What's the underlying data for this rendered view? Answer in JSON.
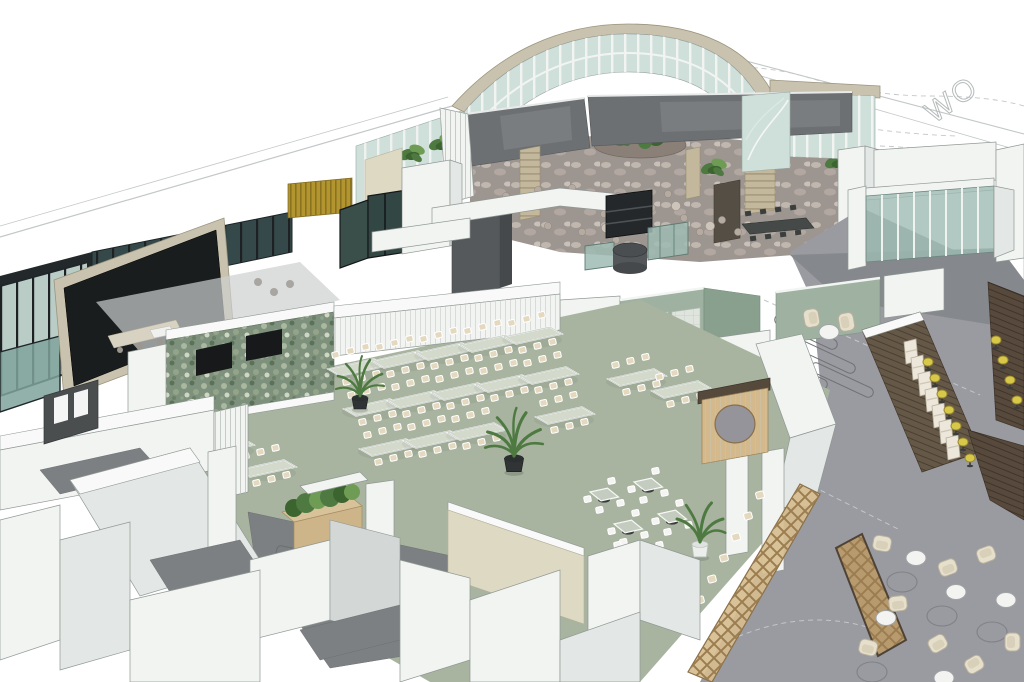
{
  "siteplan": {
    "road_text": "WO"
  },
  "colors": {
    "white": "#ffffff",
    "edge": "#909894",
    "faint": "#c3c7c8",
    "wallWhite": "#f2f4f2",
    "wallShade": "#e3e7e5",
    "wallTop": "#f8f9f8",
    "wallDeep": "#d3d8d6",
    "floorSage": "#a8b4a0",
    "sageWall": "#9fb2a2",
    "sageDark": "#8aa08e",
    "moss": "#7e917c",
    "cream": "#ded9c3",
    "tan": "#c9c2ae",
    "stone": "#c3b89c",
    "atriumFloor": "#9d9590",
    "charcoal": "#6d7072",
    "darkPanel": "#55595b",
    "black": "#1a1d1e",
    "glass": "#cfe0da",
    "glassDark": "#35494a",
    "glassTeal": "#9dbbb3",
    "mullion": "#f2f4f2",
    "gold": "#b3952f",
    "goldDark": "#8a7320",
    "woodLight": "#d3b98c",
    "woodMid": "#b79b6e",
    "woodDark": "#655847",
    "woodDeep": "#57493c",
    "corridor": "#9a9aa1",
    "corridorDark": "#85888d",
    "walkDark": "#7d8082",
    "tableTop": "#d3dacc",
    "chairSeat": "#e4d9bf",
    "taupeChair": "#b5aba1",
    "creamChair": "#e6dfcc",
    "yellow": "#d8c84a",
    "leaf": "#4e7a42",
    "leafLight": "#6f9c55",
    "leafDeep": "#3c642f",
    "pot": "#2b2f30",
    "tv": "#17191a"
  },
  "scene": {
    "dining_tables": [
      {
        "x": 178,
        "y": 424
      },
      {
        "x": 220,
        "y": 447
      },
      {
        "x": 262,
        "y": 469
      },
      {
        "x": 352,
        "y": 368
      },
      {
        "x": 396,
        "y": 360
      },
      {
        "x": 440,
        "y": 352
      },
      {
        "x": 484,
        "y": 344
      },
      {
        "x": 528,
        "y": 336
      },
      {
        "x": 368,
        "y": 408
      },
      {
        "x": 412,
        "y": 400
      },
      {
        "x": 456,
        "y": 392
      },
      {
        "x": 500,
        "y": 384
      },
      {
        "x": 544,
        "y": 376
      },
      {
        "x": 384,
        "y": 448
      },
      {
        "x": 428,
        "y": 440
      },
      {
        "x": 472,
        "y": 432
      },
      {
        "x": 560,
        "y": 416
      },
      {
        "x": 632,
        "y": 378
      },
      {
        "x": 676,
        "y": 390
      }
    ],
    "square_tables": [
      {
        "x": 604,
        "y": 494
      },
      {
        "x": 648,
        "y": 484
      },
      {
        "x": 628,
        "y": 526
      },
      {
        "x": 672,
        "y": 516
      },
      {
        "x": 652,
        "y": 558
      },
      {
        "x": 610,
        "y": 558
      }
    ],
    "fence_chairs": [
      {
        "x": 700,
        "y": 600,
        "r": -15
      },
      {
        "x": 712,
        "y": 579,
        "r": -15
      },
      {
        "x": 724,
        "y": 558,
        "r": -15
      },
      {
        "x": 736,
        "y": 537,
        "r": -15
      },
      {
        "x": 748,
        "y": 516,
        "r": -15
      },
      {
        "x": 760,
        "y": 495,
        "r": -15
      }
    ],
    "atrium_chairs": [
      {
        "x": 506,
        "y": 196
      },
      {
        "x": 522,
        "y": 207
      },
      {
        "x": 538,
        "y": 190
      },
      {
        "x": 554,
        "y": 202
      },
      {
        "x": 572,
        "y": 188
      },
      {
        "x": 588,
        "y": 200
      },
      {
        "x": 604,
        "y": 214
      },
      {
        "x": 618,
        "y": 196
      },
      {
        "x": 634,
        "y": 222
      },
      {
        "x": 652,
        "y": 208
      },
      {
        "x": 668,
        "y": 194
      },
      {
        "x": 684,
        "y": 218
      },
      {
        "x": 700,
        "y": 232
      },
      {
        "x": 722,
        "y": 220
      },
      {
        "x": 738,
        "y": 232
      },
      {
        "x": 582,
        "y": 232
      },
      {
        "x": 548,
        "y": 226
      },
      {
        "x": 616,
        "y": 240
      }
    ],
    "atrium_tables": [
      {
        "x": 514,
        "y": 204
      },
      {
        "x": 546,
        "y": 196
      },
      {
        "x": 580,
        "y": 194
      },
      {
        "x": 612,
        "y": 206
      },
      {
        "x": 644,
        "y": 216
      },
      {
        "x": 676,
        "y": 206
      },
      {
        "x": 710,
        "y": 226
      },
      {
        "x": 606,
        "y": 228
      }
    ],
    "lounge_armchairs": [
      {
        "x": 882,
        "y": 544,
        "r": 10
      },
      {
        "x": 898,
        "y": 604,
        "r": -6
      },
      {
        "x": 868,
        "y": 648,
        "r": 14
      },
      {
        "x": 948,
        "y": 568,
        "r": -20
      },
      {
        "x": 986,
        "y": 554,
        "r": 160
      },
      {
        "x": 938,
        "y": 644,
        "r": -30
      },
      {
        "x": 974,
        "y": 664,
        "r": 150
      },
      {
        "x": 1012,
        "y": 642,
        "r": 90
      },
      {
        "x": 812,
        "y": 318,
        "r": -100
      },
      {
        "x": 846,
        "y": 322,
        "r": 80
      }
    ],
    "lounge_tables": [
      {
        "x": 916,
        "y": 558
      },
      {
        "x": 886,
        "y": 618
      },
      {
        "x": 956,
        "y": 592
      },
      {
        "x": 1006,
        "y": 600
      },
      {
        "x": 944,
        "y": 678
      },
      {
        "x": 829,
        "y": 332
      }
    ],
    "lounge_rugs": [
      {
        "x": 902,
        "y": 582
      },
      {
        "x": 942,
        "y": 616
      },
      {
        "x": 872,
        "y": 672
      },
      {
        "x": 992,
        "y": 632
      }
    ],
    "bar_booths": [
      {
        "x": 910,
        "y": 352
      },
      {
        "x": 917,
        "y": 368
      },
      {
        "x": 924,
        "y": 384
      },
      {
        "x": 931,
        "y": 400
      },
      {
        "x": 938,
        "y": 416
      },
      {
        "x": 945,
        "y": 432
      },
      {
        "x": 952,
        "y": 448
      }
    ],
    "bar_stools": [
      {
        "x": 928,
        "y": 362
      },
      {
        "x": 935,
        "y": 378
      },
      {
        "x": 942,
        "y": 394
      },
      {
        "x": 949,
        "y": 410
      },
      {
        "x": 956,
        "y": 426
      },
      {
        "x": 963,
        "y": 442
      },
      {
        "x": 970,
        "y": 458
      },
      {
        "x": 996,
        "y": 340
      },
      {
        "x": 1003,
        "y": 360
      },
      {
        "x": 1010,
        "y": 380
      },
      {
        "x": 1017,
        "y": 400
      },
      {
        "x": 998,
        "y": 476
      },
      {
        "x": 1012,
        "y": 496
      }
    ],
    "queue_lines": [
      {
        "x": 806,
        "y": 332,
        "r": 25
      },
      {
        "x": 824,
        "y": 356,
        "r": 25
      },
      {
        "x": 842,
        "y": 380,
        "r": 25
      },
      {
        "x": 796,
        "y": 372,
        "r": 25
      }
    ],
    "plants_dark": [
      {
        "x": 360,
        "y": 396,
        "s": 1.0
      },
      {
        "x": 514,
        "y": 456,
        "s": 1.2
      }
    ],
    "plants_white": [
      {
        "x": 700,
        "y": 542,
        "s": 1.15
      }
    ],
    "foliage": [
      {
        "x": 382,
        "y": 166
      },
      {
        "x": 412,
        "y": 152
      },
      {
        "x": 442,
        "y": 142
      },
      {
        "x": 462,
        "y": 136
      },
      {
        "x": 838,
        "y": 160
      },
      {
        "x": 620,
        "y": 136
      },
      {
        "x": 648,
        "y": 132
      },
      {
        "x": 714,
        "y": 166
      }
    ]
  }
}
